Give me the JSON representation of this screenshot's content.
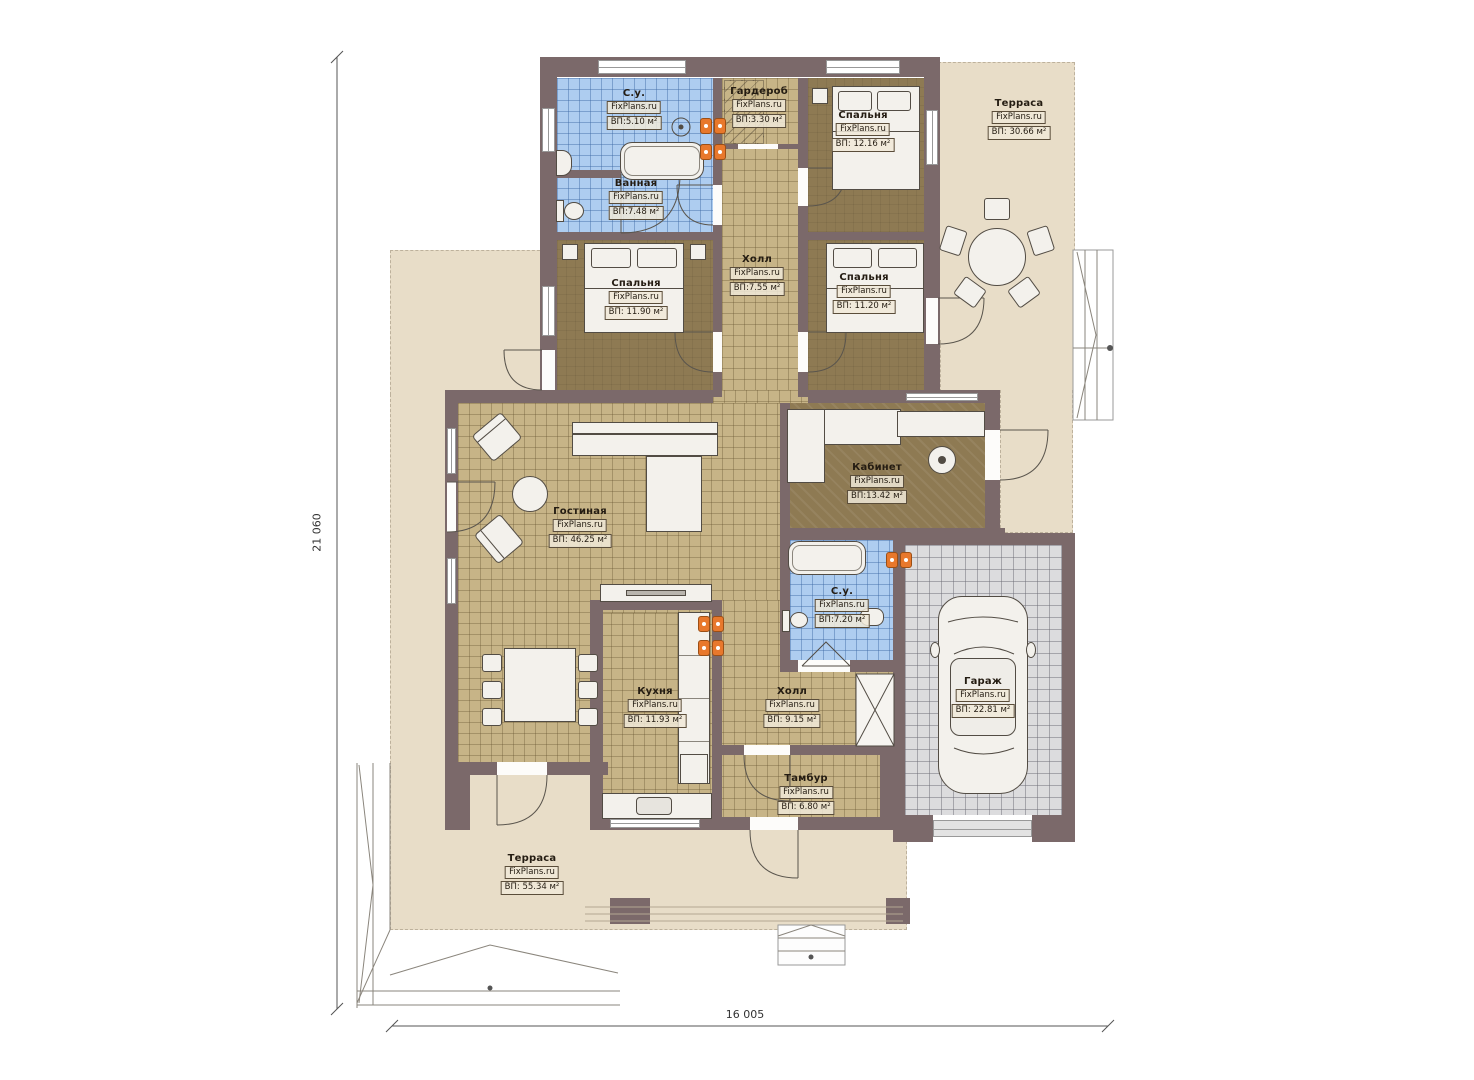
{
  "plan": {
    "watermark": "FixPlans.ru",
    "dimensions": {
      "height_total": "21 060",
      "width_total": "16 005"
    },
    "rooms": {
      "su_top": {
        "name": "С.у.",
        "area": "ВП:5.10 м²"
      },
      "vannaya": {
        "name": "Ванная",
        "area": "ВП:7.48 м²"
      },
      "garderob": {
        "name": "Гардероб",
        "area": "ВП:3.30 м²"
      },
      "bedroom_ne": {
        "name": "Спальня",
        "area": "ВП: 12.16 м²"
      },
      "terrace_right": {
        "name": "Терраса",
        "area": "ВП: 30.66 м²"
      },
      "hall_top": {
        "name": "Холл",
        "area": "ВП:7.55 м²"
      },
      "bedroom_w": {
        "name": "Спальня",
        "area": "ВП: 11.90 м²"
      },
      "bedroom_e": {
        "name": "Спальня",
        "area": "ВП: 11.20 м²"
      },
      "livingroom": {
        "name": "Гостиная",
        "area": "ВП: 46.25 м²"
      },
      "kabinet": {
        "name": "Кабинет",
        "area": "ВП:13.42 м²"
      },
      "su_bottom": {
        "name": "С.у.",
        "area": "ВП:7.20 м²"
      },
      "kitchen": {
        "name": "Кухня",
        "area": "ВП: 11.93 м²"
      },
      "hall_bottom": {
        "name": "Холл",
        "area": "ВП: 9.15 м²"
      },
      "garage": {
        "name": "Гараж",
        "area": "ВП: 22.81 м²"
      },
      "tambur": {
        "name": "Тамбур",
        "area": "ВП: 6.80 м²"
      },
      "terrace_bottom": {
        "name": "Терраса",
        "area": "ВП: 55.34 м²"
      }
    },
    "colors": {
      "wall": "#7b696a",
      "terrace": "#e8ddc8",
      "room_brown": "#8e7a53",
      "tile_tan": "#c7b487",
      "tile_blue": "#aecdf0",
      "garage_floor": "#dcdcde",
      "vent_accent": "#e8782c"
    }
  }
}
